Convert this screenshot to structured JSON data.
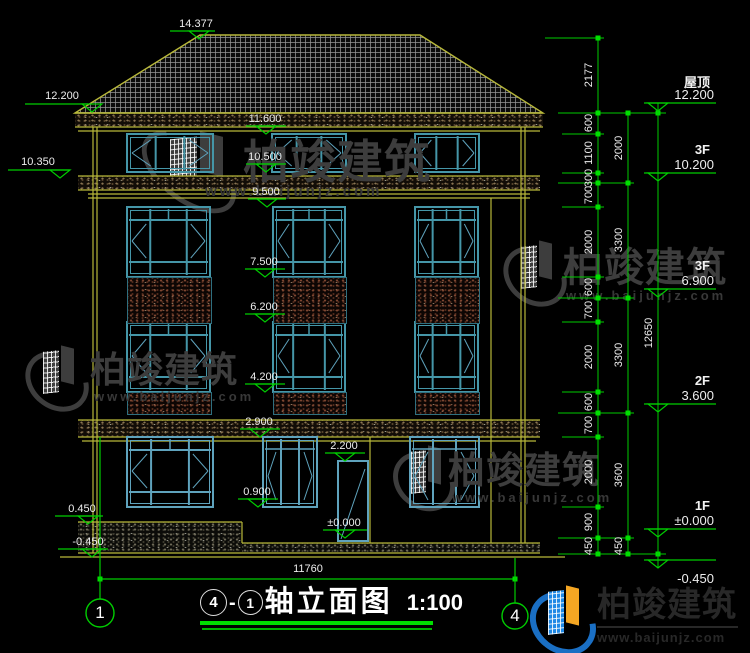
{
  "title_block": {
    "axis_from": "4",
    "dash": "-",
    "axis_to": "1",
    "name": "轴立面图",
    "scale": "1:100"
  },
  "brand": {
    "name": "柏竣建筑",
    "url": "www.baijunjz.com",
    "logo_blue": "#1a6fc4",
    "logo_blue2": "#1e88e5",
    "logo_orange": "#f5a623",
    "watermark_color": "#3d3d3d"
  },
  "colors": {
    "green": "#00cd00",
    "bright_green": "#00df00",
    "yellow": "#b8b83a",
    "teal": "#4596a8",
    "teal_dark": "#2f6f7f",
    "steel": "#5fa3bd",
    "white": "#ededed"
  },
  "elevation_markers": [
    {
      "label": "14.377",
      "cx": 196,
      "ty": 18,
      "x1": 170,
      "x2": 215,
      "ly": 31,
      "tx": 199
    },
    {
      "label": "12.200",
      "cx": 62,
      "ty": 90,
      "x1": 25,
      "x2": 88,
      "ly": 104,
      "tx": 92
    },
    {
      "label": "10.350",
      "cx": 38,
      "ty": 156,
      "x1": 8,
      "x2": 70,
      "ly": 170,
      "tx": 60
    },
    {
      "label": "0.450",
      "cx": 82,
      "ty": 503,
      "x1": 55,
      "x2": 103,
      "ly": 516,
      "tx": 88
    },
    {
      "label": "-0.450",
      "cx": 88,
      "ty": 536,
      "x1": 58,
      "x2": 108,
      "ly": 549,
      "tx": 92
    },
    {
      "label": "11.600",
      "cx": 265,
      "ty": 113,
      "x1": 246,
      "x2": 286,
      "ly": 126,
      "tx": 266
    },
    {
      "label": "10.500",
      "cx": 265,
      "ty": 151,
      "x1": 246,
      "x2": 286,
      "ly": 164,
      "tx": 266
    },
    {
      "label": "9.500",
      "cx": 266,
      "ty": 186,
      "x1": 248,
      "x2": 286,
      "ly": 199,
      "tx": 267
    },
    {
      "label": "7.500",
      "cx": 264,
      "ty": 256,
      "x1": 245,
      "x2": 285,
      "ly": 269,
      "tx": 265
    },
    {
      "label": "6.200",
      "cx": 264,
      "ty": 301,
      "x1": 245,
      "x2": 285,
      "ly": 314,
      "tx": 265
    },
    {
      "label": "4.200",
      "cx": 264,
      "ty": 371,
      "x1": 245,
      "x2": 285,
      "ly": 384,
      "tx": 265
    },
    {
      "label": "2.900",
      "cx": 259,
      "ty": 416,
      "x1": 240,
      "x2": 280,
      "ly": 429,
      "tx": 260
    },
    {
      "label": "2.200",
      "cx": 344,
      "ty": 440,
      "x1": 325,
      "x2": 365,
      "ly": 453,
      "tx": 345
    },
    {
      "label": "0.900",
      "cx": 257,
      "ty": 486,
      "x1": 238,
      "x2": 278,
      "ly": 499,
      "tx": 258
    },
    {
      "label": "±0.000",
      "cx": 344,
      "ty": 517,
      "x1": 323,
      "x2": 367,
      "ly": 530,
      "tx": 345
    }
  ],
  "floor_markers": [
    {
      "floor": "屋顶",
      "value": "12.200",
      "ly": 103,
      "below": false
    },
    {
      "floor": "3F",
      "value": "10.200",
      "ly": 173,
      "below": false
    },
    {
      "floor": "3F",
      "value": "6.900",
      "ly": 289,
      "below": false
    },
    {
      "floor": "2F",
      "value": "3.600",
      "ly": 404,
      "below": false
    },
    {
      "floor": "1F",
      "value": "±0.000",
      "ly": 529,
      "below": false
    },
    {
      "floor": "",
      "value": "-0.450",
      "ly": 560,
      "below": true
    }
  ],
  "dim_chains": [
    {
      "x": 598,
      "y1": 38,
      "y2": 554,
      "ticks": [
        38,
        113,
        134,
        173,
        183,
        207,
        277,
        298,
        322,
        392,
        413,
        437,
        507,
        538,
        554
      ],
      "labels": [
        {
          "t": "2177",
          "y": 75
        },
        {
          "t": "600",
          "y": 123
        },
        {
          "t": "1100",
          "y": 153
        },
        {
          "t": "300",
          "y": 178
        },
        {
          "t": "700",
          "y": 195
        },
        {
          "t": "2000",
          "y": 242
        },
        {
          "t": "600",
          "y": 287
        },
        {
          "t": "700",
          "y": 310
        },
        {
          "t": "2000",
          "y": 357
        },
        {
          "t": "600",
          "y": 402
        },
        {
          "t": "700",
          "y": 425
        },
        {
          "t": "2000",
          "y": 472
        },
        {
          "t": "900",
          "y": 522
        },
        {
          "t": "450",
          "y": 546
        }
      ]
    },
    {
      "x": 628,
      "y1": 113,
      "y2": 554,
      "ticks": [
        113,
        183,
        298,
        413,
        538,
        554
      ],
      "labels": [
        {
          "t": "2000",
          "y": 148
        },
        {
          "t": "3300",
          "y": 240
        },
        {
          "t": "3300",
          "y": 355
        },
        {
          "t": "3600",
          "y": 475
        },
        {
          "t": "450",
          "y": 546
        }
      ]
    },
    {
      "x": 658,
      "y1": 103,
      "y2": 568,
      "ticks": [
        113,
        554
      ],
      "labels": [
        {
          "t": "12650",
          "y": 333
        }
      ]
    }
  ],
  "witness_lines": [
    {
      "y": 38,
      "x1": 545,
      "x2": 604
    },
    {
      "y": 113,
      "x1": 558,
      "x2": 666
    },
    {
      "y": 134,
      "x1": 562,
      "x2": 604
    },
    {
      "y": 173,
      "x1": 562,
      "x2": 604
    },
    {
      "y": 183,
      "x1": 558,
      "x2": 634
    },
    {
      "y": 207,
      "x1": 562,
      "x2": 604
    },
    {
      "y": 277,
      "x1": 562,
      "x2": 604
    },
    {
      "y": 298,
      "x1": 558,
      "x2": 634
    },
    {
      "y": 322,
      "x1": 562,
      "x2": 604
    },
    {
      "y": 392,
      "x1": 562,
      "x2": 604
    },
    {
      "y": 413,
      "x1": 558,
      "x2": 634
    },
    {
      "y": 437,
      "x1": 562,
      "x2": 604
    },
    {
      "y": 507,
      "x1": 562,
      "x2": 604
    },
    {
      "y": 538,
      "x1": 558,
      "x2": 634
    },
    {
      "y": 554,
      "x1": 558,
      "x2": 666
    }
  ],
  "bottom_dim": {
    "label": "11760",
    "line_y": 579,
    "x1": 100,
    "x2": 515,
    "text_cx": 308,
    "text_y": 563,
    "axes": [
      {
        "num": "1",
        "x": 100,
        "cy": 613,
        "r": 14,
        "top_y": 437
      },
      {
        "num": "4",
        "x": 515,
        "cy": 616,
        "r": 13,
        "top_y": 558
      }
    ]
  },
  "watermarks": [
    {
      "x": 140,
      "y": 133,
      "iw": 100,
      "ih": 64,
      "tx": 243,
      "ty": 139,
      "fs": 46,
      "wx": 205,
      "wy": 184,
      "wfs": 15
    },
    {
      "x": 504,
      "y": 241,
      "iw": 58,
      "ih": 58,
      "tx": 563,
      "ty": 248,
      "fs": 40,
      "wx": 566,
      "wy": 289,
      "wfs": 13
    },
    {
      "x": 26,
      "y": 346,
      "iw": 58,
      "ih": 58,
      "tx": 90,
      "ty": 352,
      "fs": 36,
      "wx": 94,
      "wy": 390,
      "wfs": 13
    },
    {
      "x": 394,
      "y": 446,
      "iw": 56,
      "ih": 58,
      "tx": 448,
      "ty": 452,
      "fs": 37,
      "wx": 452,
      "wy": 491,
      "wfs": 13
    }
  ],
  "facade": {
    "roof_outline": "75,113 200,35 420,35 543,113",
    "bands": [
      {
        "kind": "tan",
        "x": 75,
        "y": 113,
        "w": 468,
        "h": 14
      },
      {
        "kind": "tan",
        "x": 78,
        "y": 176,
        "w": 462,
        "h": 14
      },
      {
        "kind": "tan",
        "x": 78,
        "y": 420,
        "w": 462,
        "h": 17
      },
      {
        "kind": "gray",
        "x": 78,
        "y": 522,
        "w": 164,
        "h": 31
      },
      {
        "kind": "gray",
        "x": 242,
        "y": 543,
        "w": 298,
        "h": 10
      }
    ],
    "hlines": [
      {
        "y": 113,
        "x1": 75,
        "x2": 543
      },
      {
        "y": 127,
        "x1": 75,
        "x2": 543
      },
      {
        "y": 131,
        "x1": 78,
        "x2": 540
      },
      {
        "y": 176,
        "x1": 78,
        "x2": 540
      },
      {
        "y": 190,
        "x1": 78,
        "x2": 540
      },
      {
        "y": 194,
        "x1": 88,
        "x2": 530
      },
      {
        "y": 198,
        "x1": 88,
        "x2": 530
      },
      {
        "y": 420,
        "x1": 78,
        "x2": 540
      },
      {
        "y": 437,
        "x1": 78,
        "x2": 540
      },
      {
        "y": 441,
        "x1": 82,
        "x2": 536
      },
      {
        "y": 522,
        "x1": 78,
        "x2": 242
      },
      {
        "y": 543,
        "x1": 242,
        "x2": 540
      },
      {
        "y": 553,
        "x1": 78,
        "x2": 540
      },
      {
        "y": 557,
        "x1": 60,
        "x2": 565
      }
    ],
    "vlines": [
      {
        "x": 93,
        "y1": 127,
        "y2": 553
      },
      {
        "x": 97,
        "y1": 127,
        "y2": 553
      },
      {
        "x": 521,
        "y1": 127,
        "y2": 543
      },
      {
        "x": 525,
        "y1": 127,
        "y2": 543
      },
      {
        "x": 491,
        "y1": 198,
        "y2": 543
      },
      {
        "x": 370,
        "y1": 437,
        "y2": 543
      },
      {
        "x": 242,
        "y1": 522,
        "y2": 543
      }
    ],
    "attic_windows": [
      {
        "x": 127,
        "y": 134,
        "w": 86,
        "h": 38
      },
      {
        "x": 272,
        "y": 134,
        "w": 74,
        "h": 38
      },
      {
        "x": 415,
        "y": 134,
        "w": 64,
        "h": 38
      }
    ],
    "tall_cols": [
      {
        "x": 127,
        "w": 83
      },
      {
        "x": 273,
        "w": 72
      },
      {
        "x": 415,
        "w": 63
      }
    ],
    "tall_rows": [
      {
        "y": 207,
        "h": 70
      },
      {
        "y": 322,
        "h": 70
      }
    ],
    "rails": [
      {
        "y": 277,
        "h": 45
      },
      {
        "y": 392,
        "h": 21
      }
    ],
    "f1_windows": [
      {
        "x": 127,
        "y": 437,
        "w": 86,
        "h": 70,
        "type": "tall"
      },
      {
        "x": 263,
        "y": 437,
        "w": 54,
        "h": 70,
        "type": "simple"
      },
      {
        "x": 410,
        "y": 437,
        "w": 69,
        "h": 70,
        "type": "simple"
      }
    ],
    "door": {
      "x": 338,
      "y": 461,
      "w": 30,
      "h": 80
    }
  }
}
